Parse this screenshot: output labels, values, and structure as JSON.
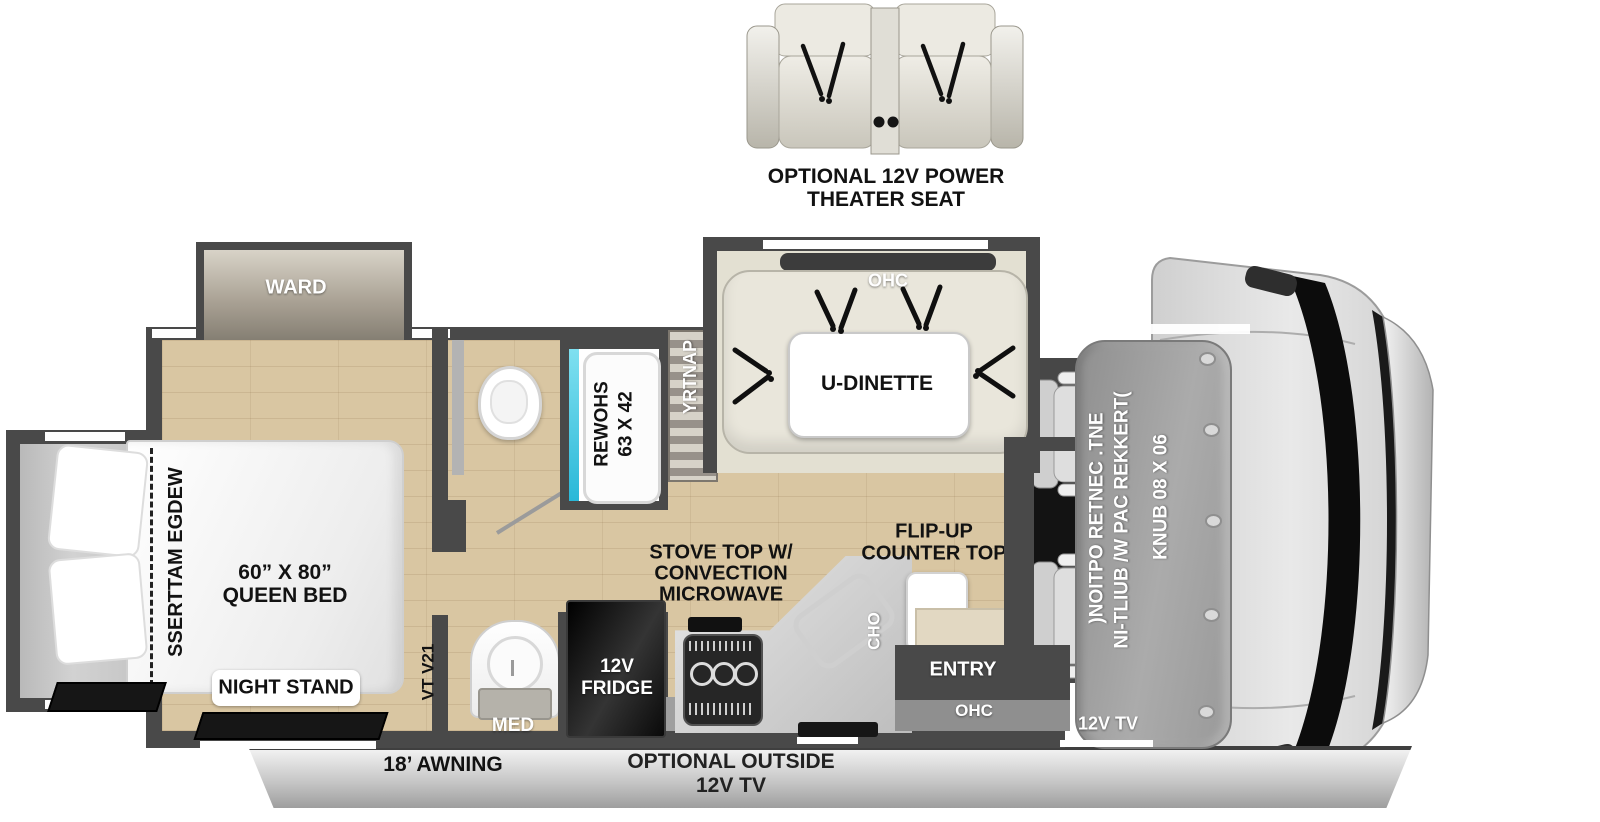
{
  "floorplan": {
    "theater_seat": {
      "line1": "OPTIONAL 12V POWER",
      "line2": "THEATER SEAT"
    },
    "bedroom": {
      "ward": "WARD",
      "wedge": "WEDGE MATTRESS",
      "queen_line1": "60” X 80”",
      "queen_line2": "QUEEN BED",
      "night_stand": "NIGHT STAND",
      "tv": "12V TV"
    },
    "bath": {
      "shower_line1": "24 X 36",
      "shower_line2": "SHOWER",
      "med": "MED"
    },
    "kitchen": {
      "pantry": "PANTRY",
      "stove_line1": "STOVE TOP W/",
      "stove_line2": "CONVECTION",
      "stove_line3": "MICROWAVE",
      "fridge_line1": "12V",
      "fridge_line2": "FRIDGE",
      "flip_line1": "FLIP-UP",
      "flip_line2": "COUNTER TOP",
      "ohc": "OHC"
    },
    "dinette": {
      "label": "U-DINETTE",
      "ohc": "OHC"
    },
    "entry": {
      "label": "ENTRY",
      "ohc": "OHC"
    },
    "front": {
      "bunk_line1": "(TREKKER CAP W/ BUILT-IN",
      "bunk_line2": "ENT. CENTER OPTION)",
      "bunk_size": "60 X 80 BUNK",
      "tv": "12V TV"
    },
    "exterior": {
      "awning": "18’ AWNING",
      "outside_tv_line1": "OPTIONAL OUTSIDE",
      "outside_tv_line2": "12V TV"
    }
  },
  "colors": {
    "wall": "#494949",
    "wood_floor": "#d9c6a2",
    "slide_floor": "#c6c6c6",
    "dinette_floor": "#e3e0d2",
    "sofa_beige": "#e9e6db",
    "shower_accent": "#3ec6e0",
    "bunk_gray": "#9c9c9c",
    "awning_bar": "#d8d8d8",
    "label_black": "#111111",
    "label_white": "#ffffff"
  },
  "icons": {
    "seatbelt": "v-strap-lines",
    "toilet": "oval-bowl",
    "bath_sink": "round-bowl",
    "kitchen_sink": "rotated-basin-outline",
    "stove": "three-burner-grate",
    "floor_mat": "black-parallelogram",
    "rivet": "small-circle"
  }
}
